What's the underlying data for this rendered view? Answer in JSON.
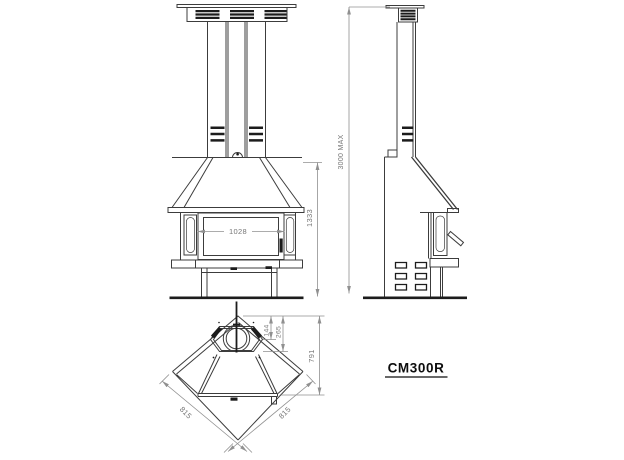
{
  "labels": {
    "model": "CM300R",
    "front_width": "1028",
    "front_height": "1333",
    "side_max_height": "3000 MAX",
    "plan_flue_width": "144",
    "plan_flue_depth": "265",
    "plan_depth": "791",
    "plan_side_left": "815",
    "plan_side_right": "815"
  },
  "colors": {
    "background": "#ffffff",
    "line": "#3c3c3c",
    "dark": "#1c1c1c",
    "dim_line": "#909090",
    "dim_text": "#767676",
    "model_text": "#0d0d0d"
  }
}
